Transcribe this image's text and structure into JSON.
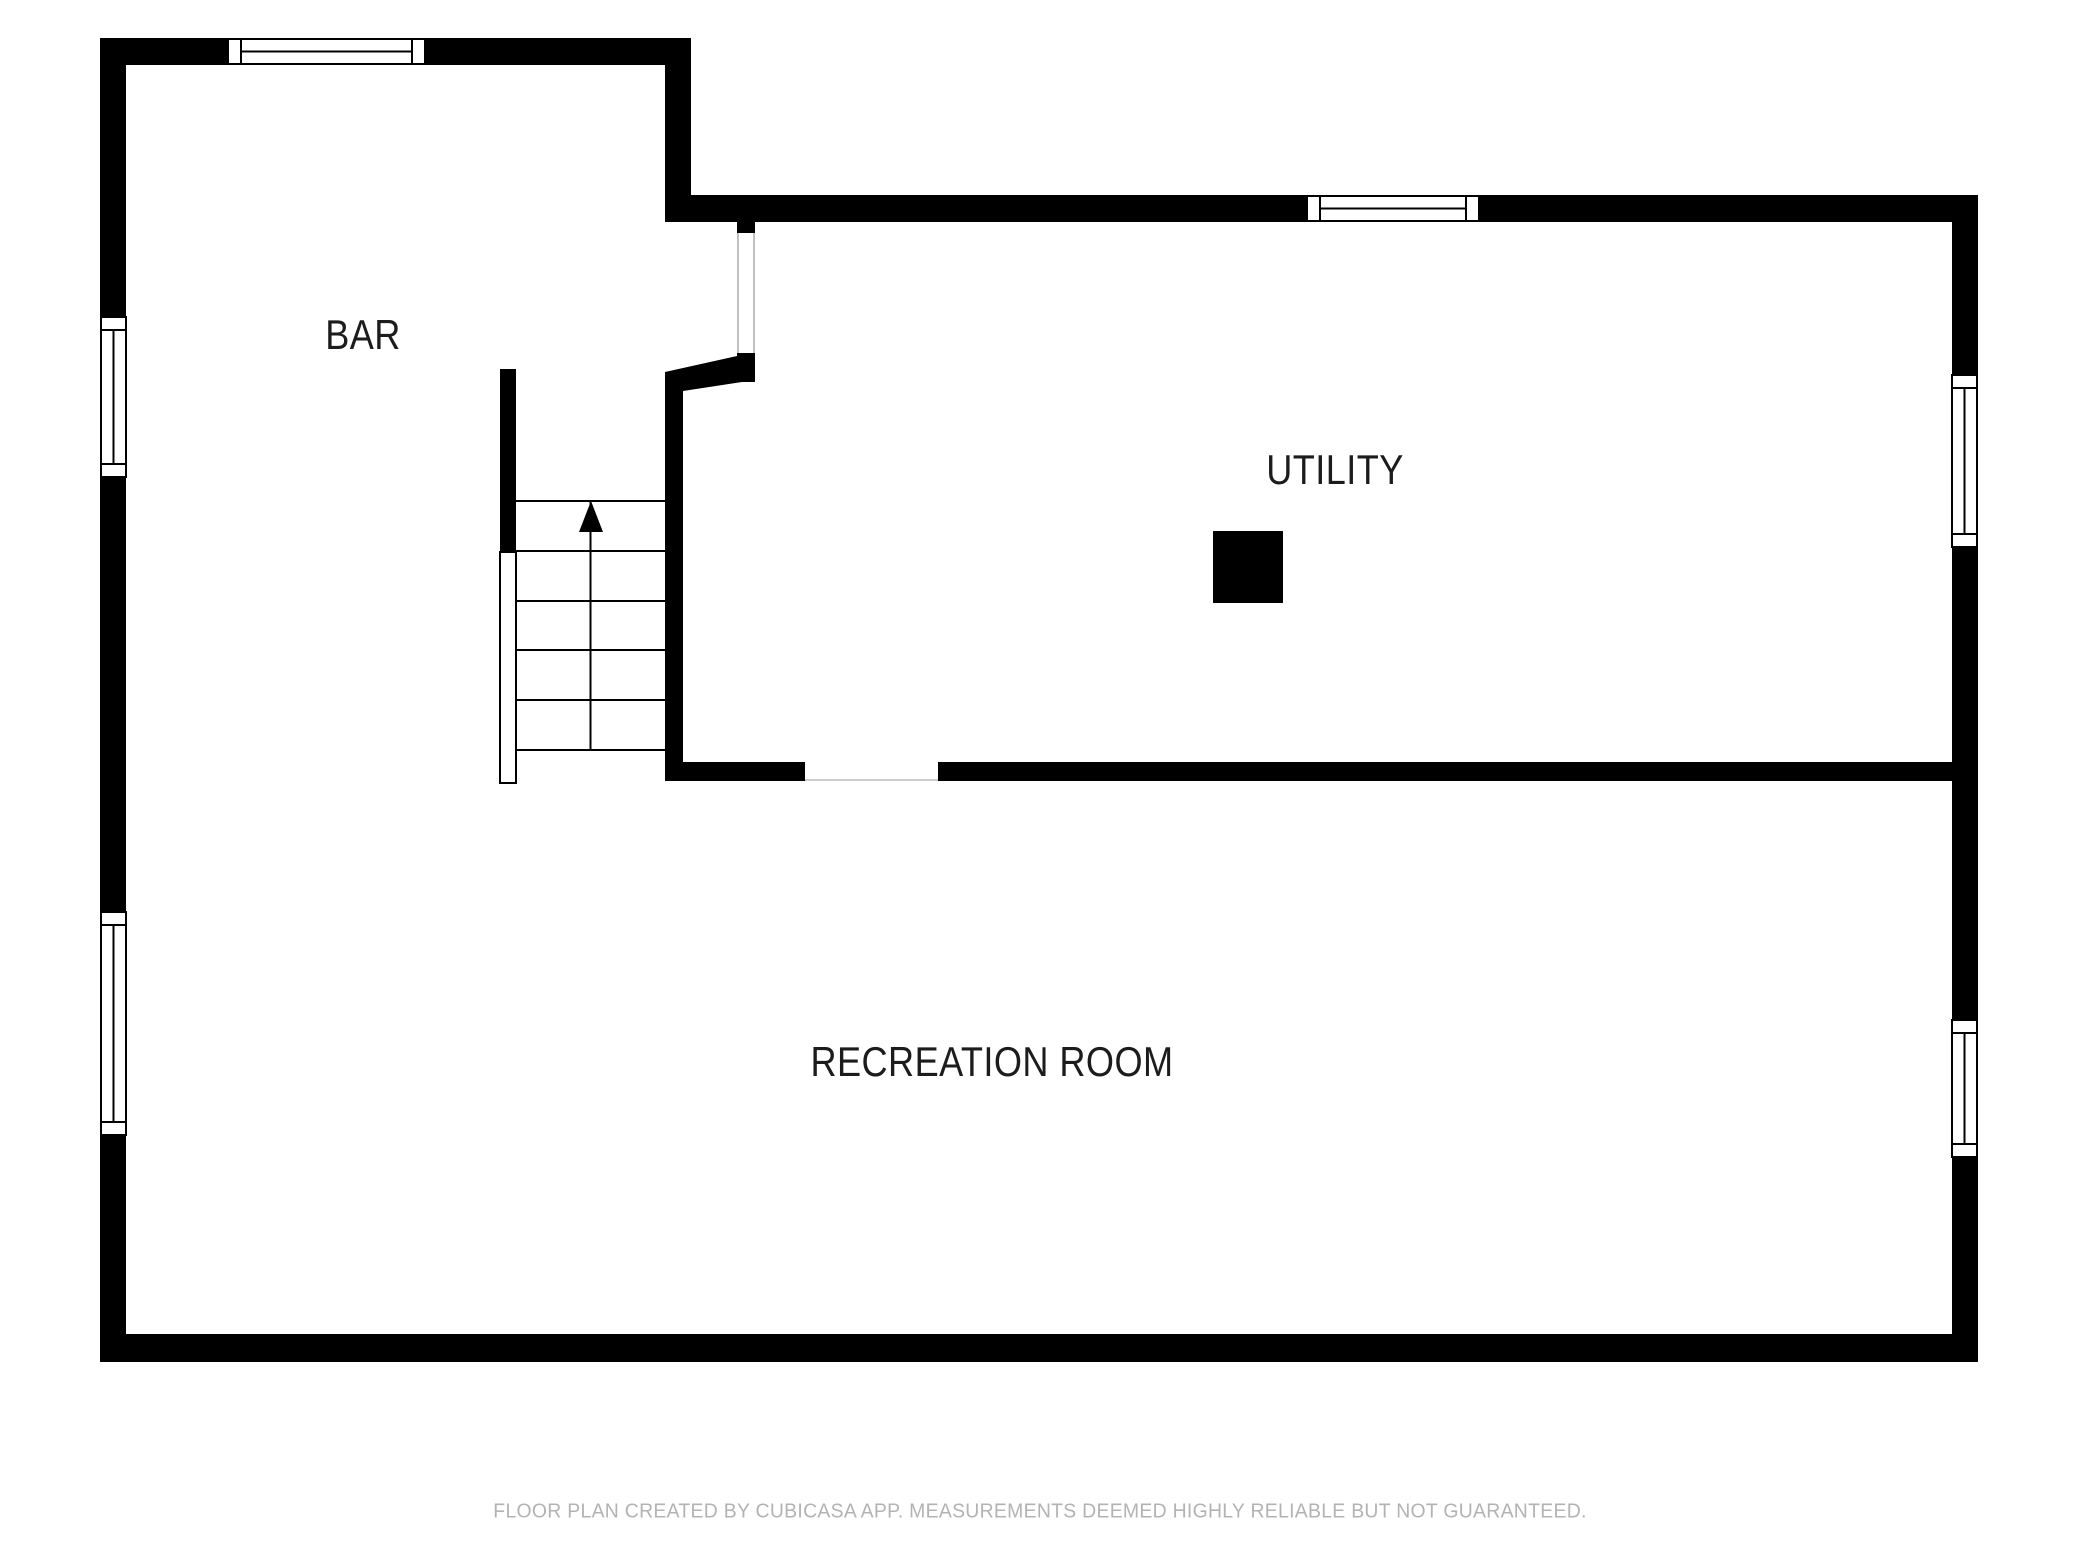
{
  "title": "Basement floor plan",
  "colors": {
    "background": "#ffffff",
    "wall": "#000000",
    "room_label": "#1c1c1c",
    "stair_lines": "#000000",
    "door_jamb": "#aaaaaa",
    "door_sill": "#cccccc",
    "footer_text": "#b3b3b3"
  },
  "rooms": [
    {
      "label": "BAR"
    },
    {
      "label": "UTILITY"
    },
    {
      "label": "RECREATION ROOM"
    }
  ],
  "features": {
    "staircase": {
      "icon": "stairs-up-arrow-icon",
      "direction": "up",
      "tread_lines": 6,
      "runs": 2
    },
    "furnace": {
      "icon": "furnace-square"
    },
    "window_count": 6,
    "door_opening_count": 2
  },
  "footer": {
    "text": "FLOOR PLAN CREATED BY CUBICASA APP. MEASUREMENTS DEEMED HIGHLY RELIABLE BUT NOT GUARANTEED."
  }
}
